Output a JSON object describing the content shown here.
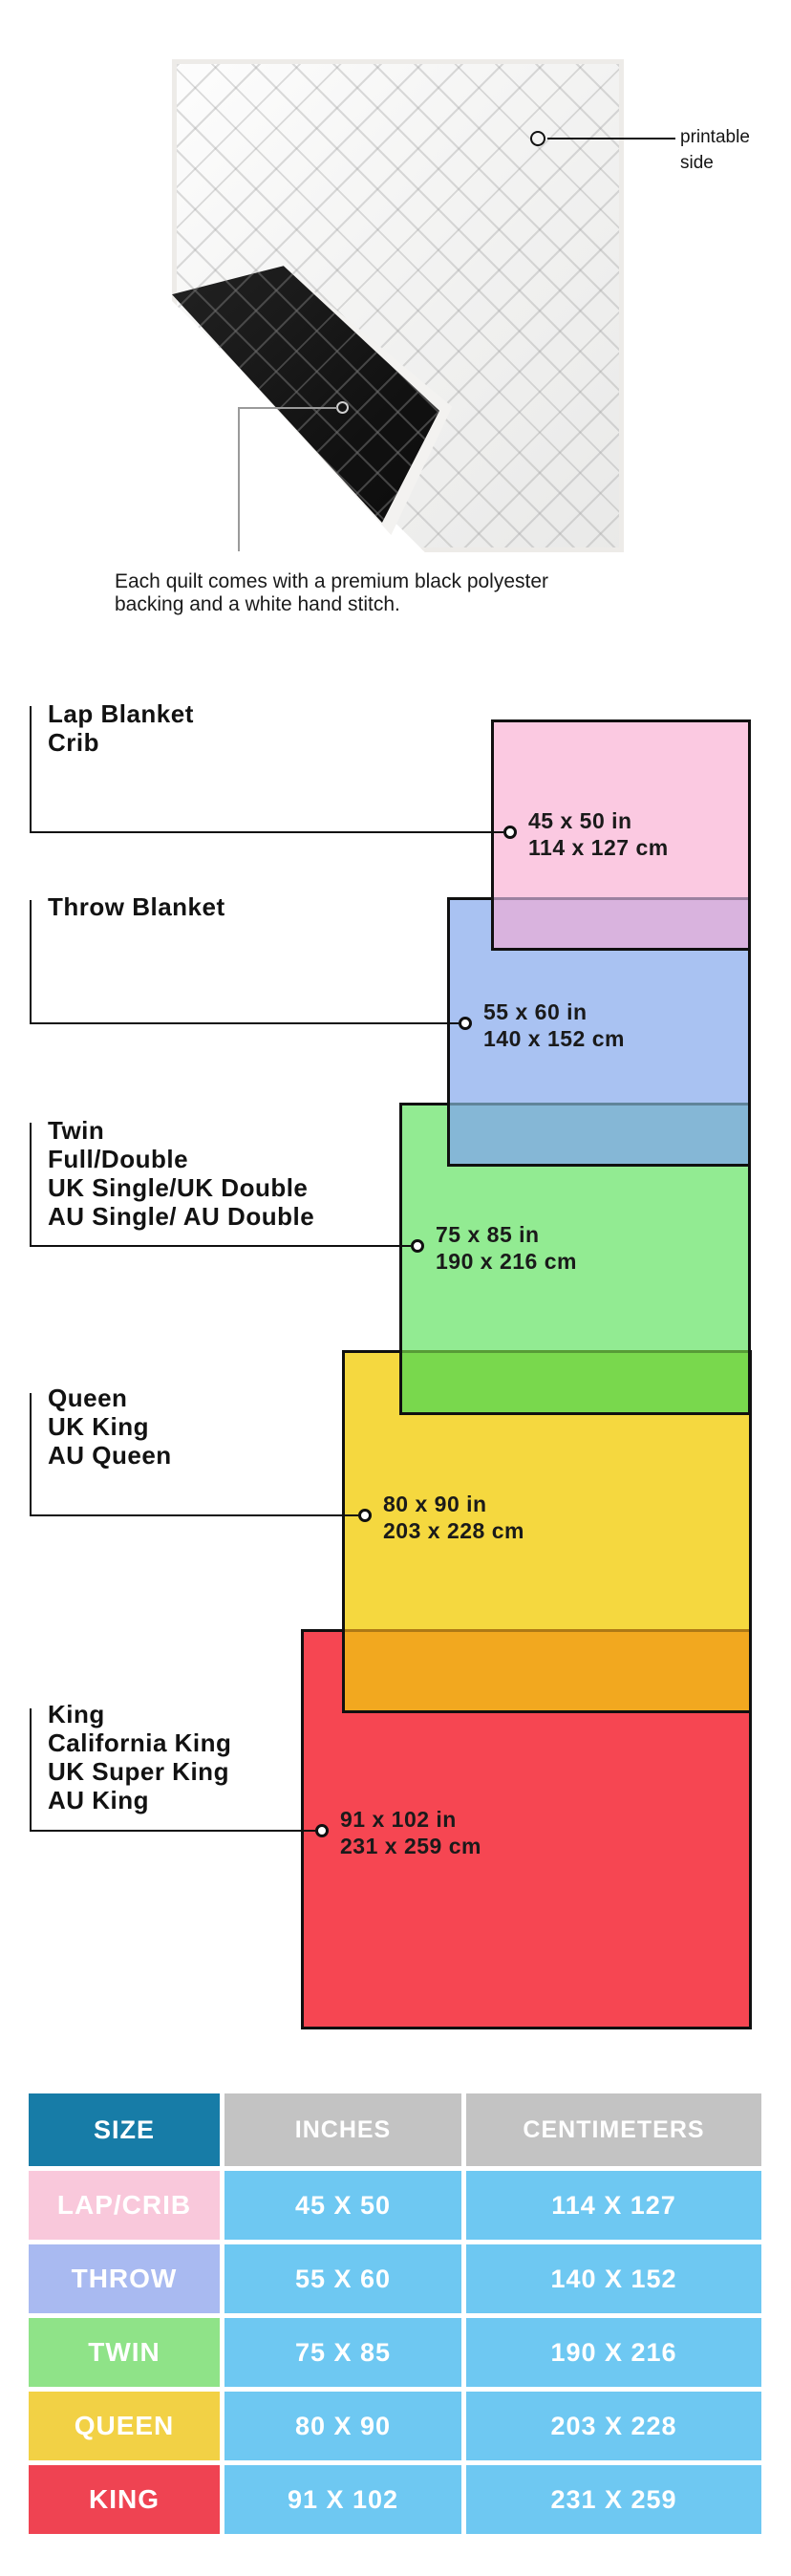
{
  "quilt": {
    "printable_label_line1": "printable",
    "printable_label_line2": "side",
    "caption_line1": "Each quilt comes with a premium black polyester",
    "caption_line2": "backing and a white hand stitch."
  },
  "diagram": {
    "sizes": [
      {
        "id": "lap",
        "labels": [
          "Lap Blanket",
          "Crib"
        ],
        "inches": "45 x 50 in",
        "cm": "114 x 127 cm",
        "color": "#FBC9E1"
      },
      {
        "id": "throw",
        "labels": [
          "Throw Blanket"
        ],
        "inches": "55 x 60 in",
        "cm": "140 x 152 cm",
        "color": "#A9C2F2"
      },
      {
        "id": "twin",
        "labels": [
          "Twin",
          "Full/Double",
          "UK Single/UK Double",
          "AU Single/ AU Double"
        ],
        "inches": "75 x 85 in",
        "cm": "190 x 216 cm",
        "color": "#92EB92"
      },
      {
        "id": "queen",
        "labels": [
          "Queen",
          "UK King",
          "AU Queen"
        ],
        "inches": "80 x 90 in",
        "cm": "203 x 228 cm",
        "color": "#F5D83F"
      },
      {
        "id": "king",
        "labels": [
          "King",
          "California King",
          "UK Super King",
          "AU King"
        ],
        "inches": "91 x 102 in",
        "cm": "231 x 259 cm",
        "color": "#F64652"
      }
    ],
    "overlaps": [
      {
        "pair": "lap-throw",
        "color": "#D9B3DE"
      },
      {
        "pair": "throw-twin",
        "color": "#85B7D6"
      },
      {
        "pair": "twin-queen",
        "color": "#79D84D"
      },
      {
        "pair": "queen-king",
        "color": "#F2A81F"
      }
    ]
  },
  "table": {
    "headers": {
      "size": "SIZE",
      "inches": "INCHES",
      "centimeters": "CENTIMETERS"
    },
    "header_colors": {
      "size_bg": "#177CA7",
      "other_bg": "#C3C3C3",
      "value_bg": "#6EC8F2"
    },
    "rows": [
      {
        "size": "LAP/CRIB",
        "inches": "45 X 50",
        "cm": "114 X 127",
        "color": "#F9C8DB"
      },
      {
        "size": "THROW",
        "inches": "55 X 60",
        "cm": "140 X 152",
        "color": "#A9BAF1"
      },
      {
        "size": "TWIN",
        "inches": "75 X 85",
        "cm": "190 X 216",
        "color": "#8FE388"
      },
      {
        "size": "QUEEN",
        "inches": "80 X 90",
        "cm": "203 X 228",
        "color": "#F2D145"
      },
      {
        "size": "KING",
        "inches": "91 X 102",
        "cm": "231 X 259",
        "color": "#EF4352"
      }
    ]
  }
}
